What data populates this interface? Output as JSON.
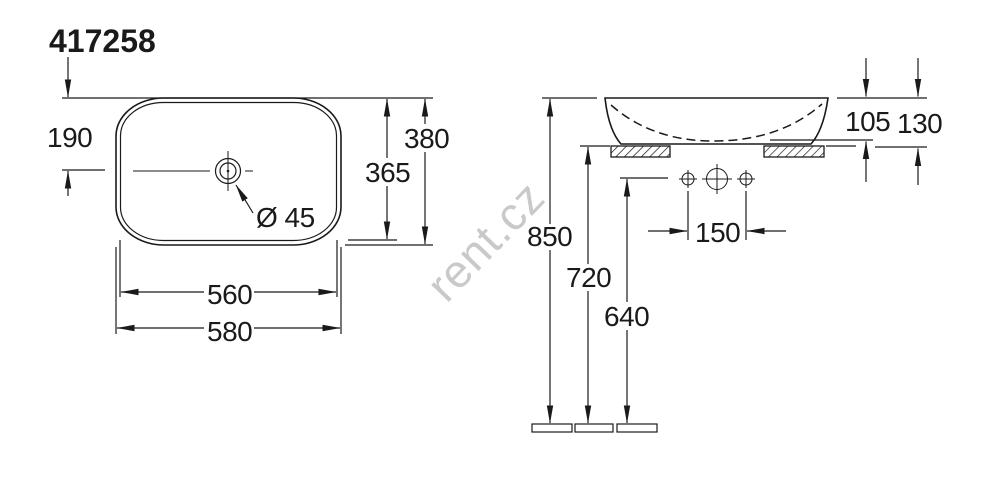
{
  "title": "417258",
  "watermark": "rent.cz",
  "colors": {
    "line": "#1a1a1a",
    "text": "#1a1a1a",
    "watermark": "#c9c9c9",
    "background": "#ffffff"
  },
  "top_view": {
    "dimensions": {
      "drain_center_offset": "190",
      "overall_depth": "380",
      "inner_depth": "365",
      "drain_diameter": "Ø 45",
      "inner_width": "560",
      "overall_width": "580"
    }
  },
  "front_view": {
    "dimensions": {
      "height_above_counter": "105",
      "total_height": "130",
      "rim_height_from_floor": "850",
      "counter_height": "720",
      "tap_hole_height": "640",
      "tap_hole_spacing": "150"
    }
  }
}
